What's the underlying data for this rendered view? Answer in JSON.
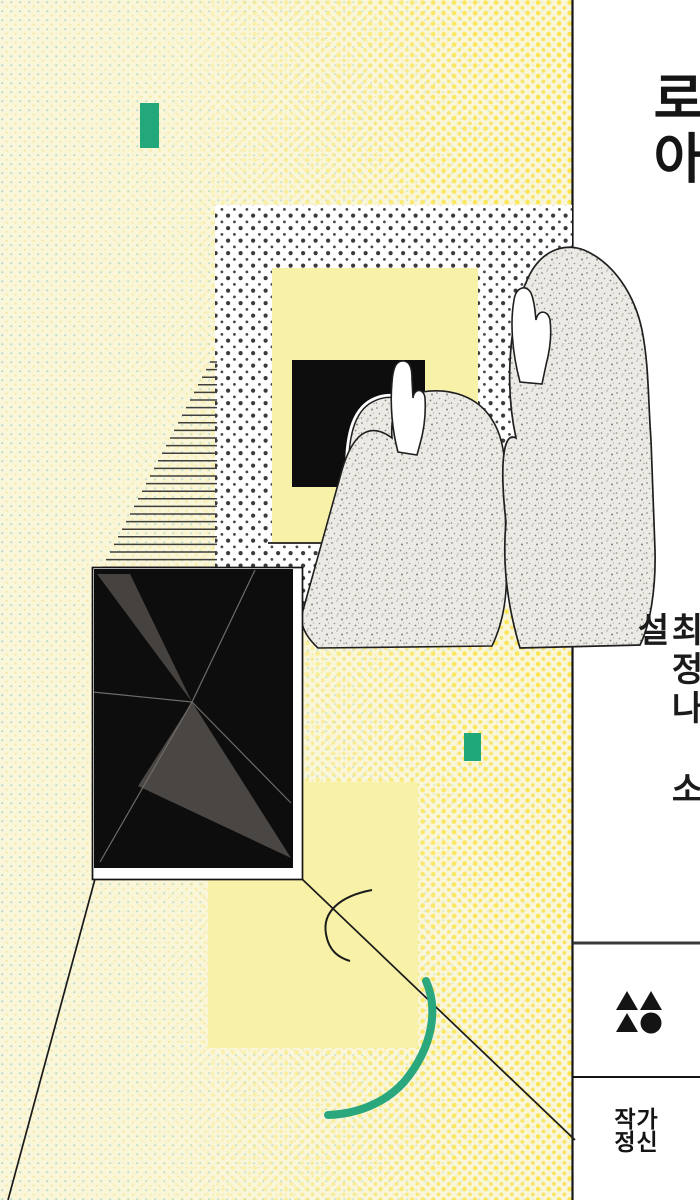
{
  "cover": {
    "title": "로아",
    "author_line": "최정나 소설",
    "author": "최정나",
    "genre_label": "소설",
    "publisher": "작가정신",
    "publisher_line1": "작가",
    "publisher_line2": "정신"
  },
  "colors": {
    "background_cream": "#faf6da",
    "halftone_yellow_dot": "#fbe44c",
    "halftone_cyan_dot": "#a6d8cf",
    "collage_dot": "#3b3b3b",
    "pale_yellow_panel": "#f8f2a8",
    "accent_green": "#23a87c",
    "teal_arc": "#2aa77d",
    "canvas_black": "#0d0d0d",
    "canvas_grey_triangle": "#474340",
    "panel_white": "#ffffff",
    "ink": "#151515"
  },
  "artwork": {
    "elements": [
      "halftone-background",
      "green-accent-rect-top",
      "green-accent-rect-middle",
      "dotted-collage-panel",
      "yellow-inner-panel",
      "black-window",
      "small-figure",
      "medium-figure",
      "large-figure",
      "hatch-lines",
      "black-canvas-with-triangles",
      "perspective-lines",
      "black-arc",
      "green-arc"
    ]
  }
}
